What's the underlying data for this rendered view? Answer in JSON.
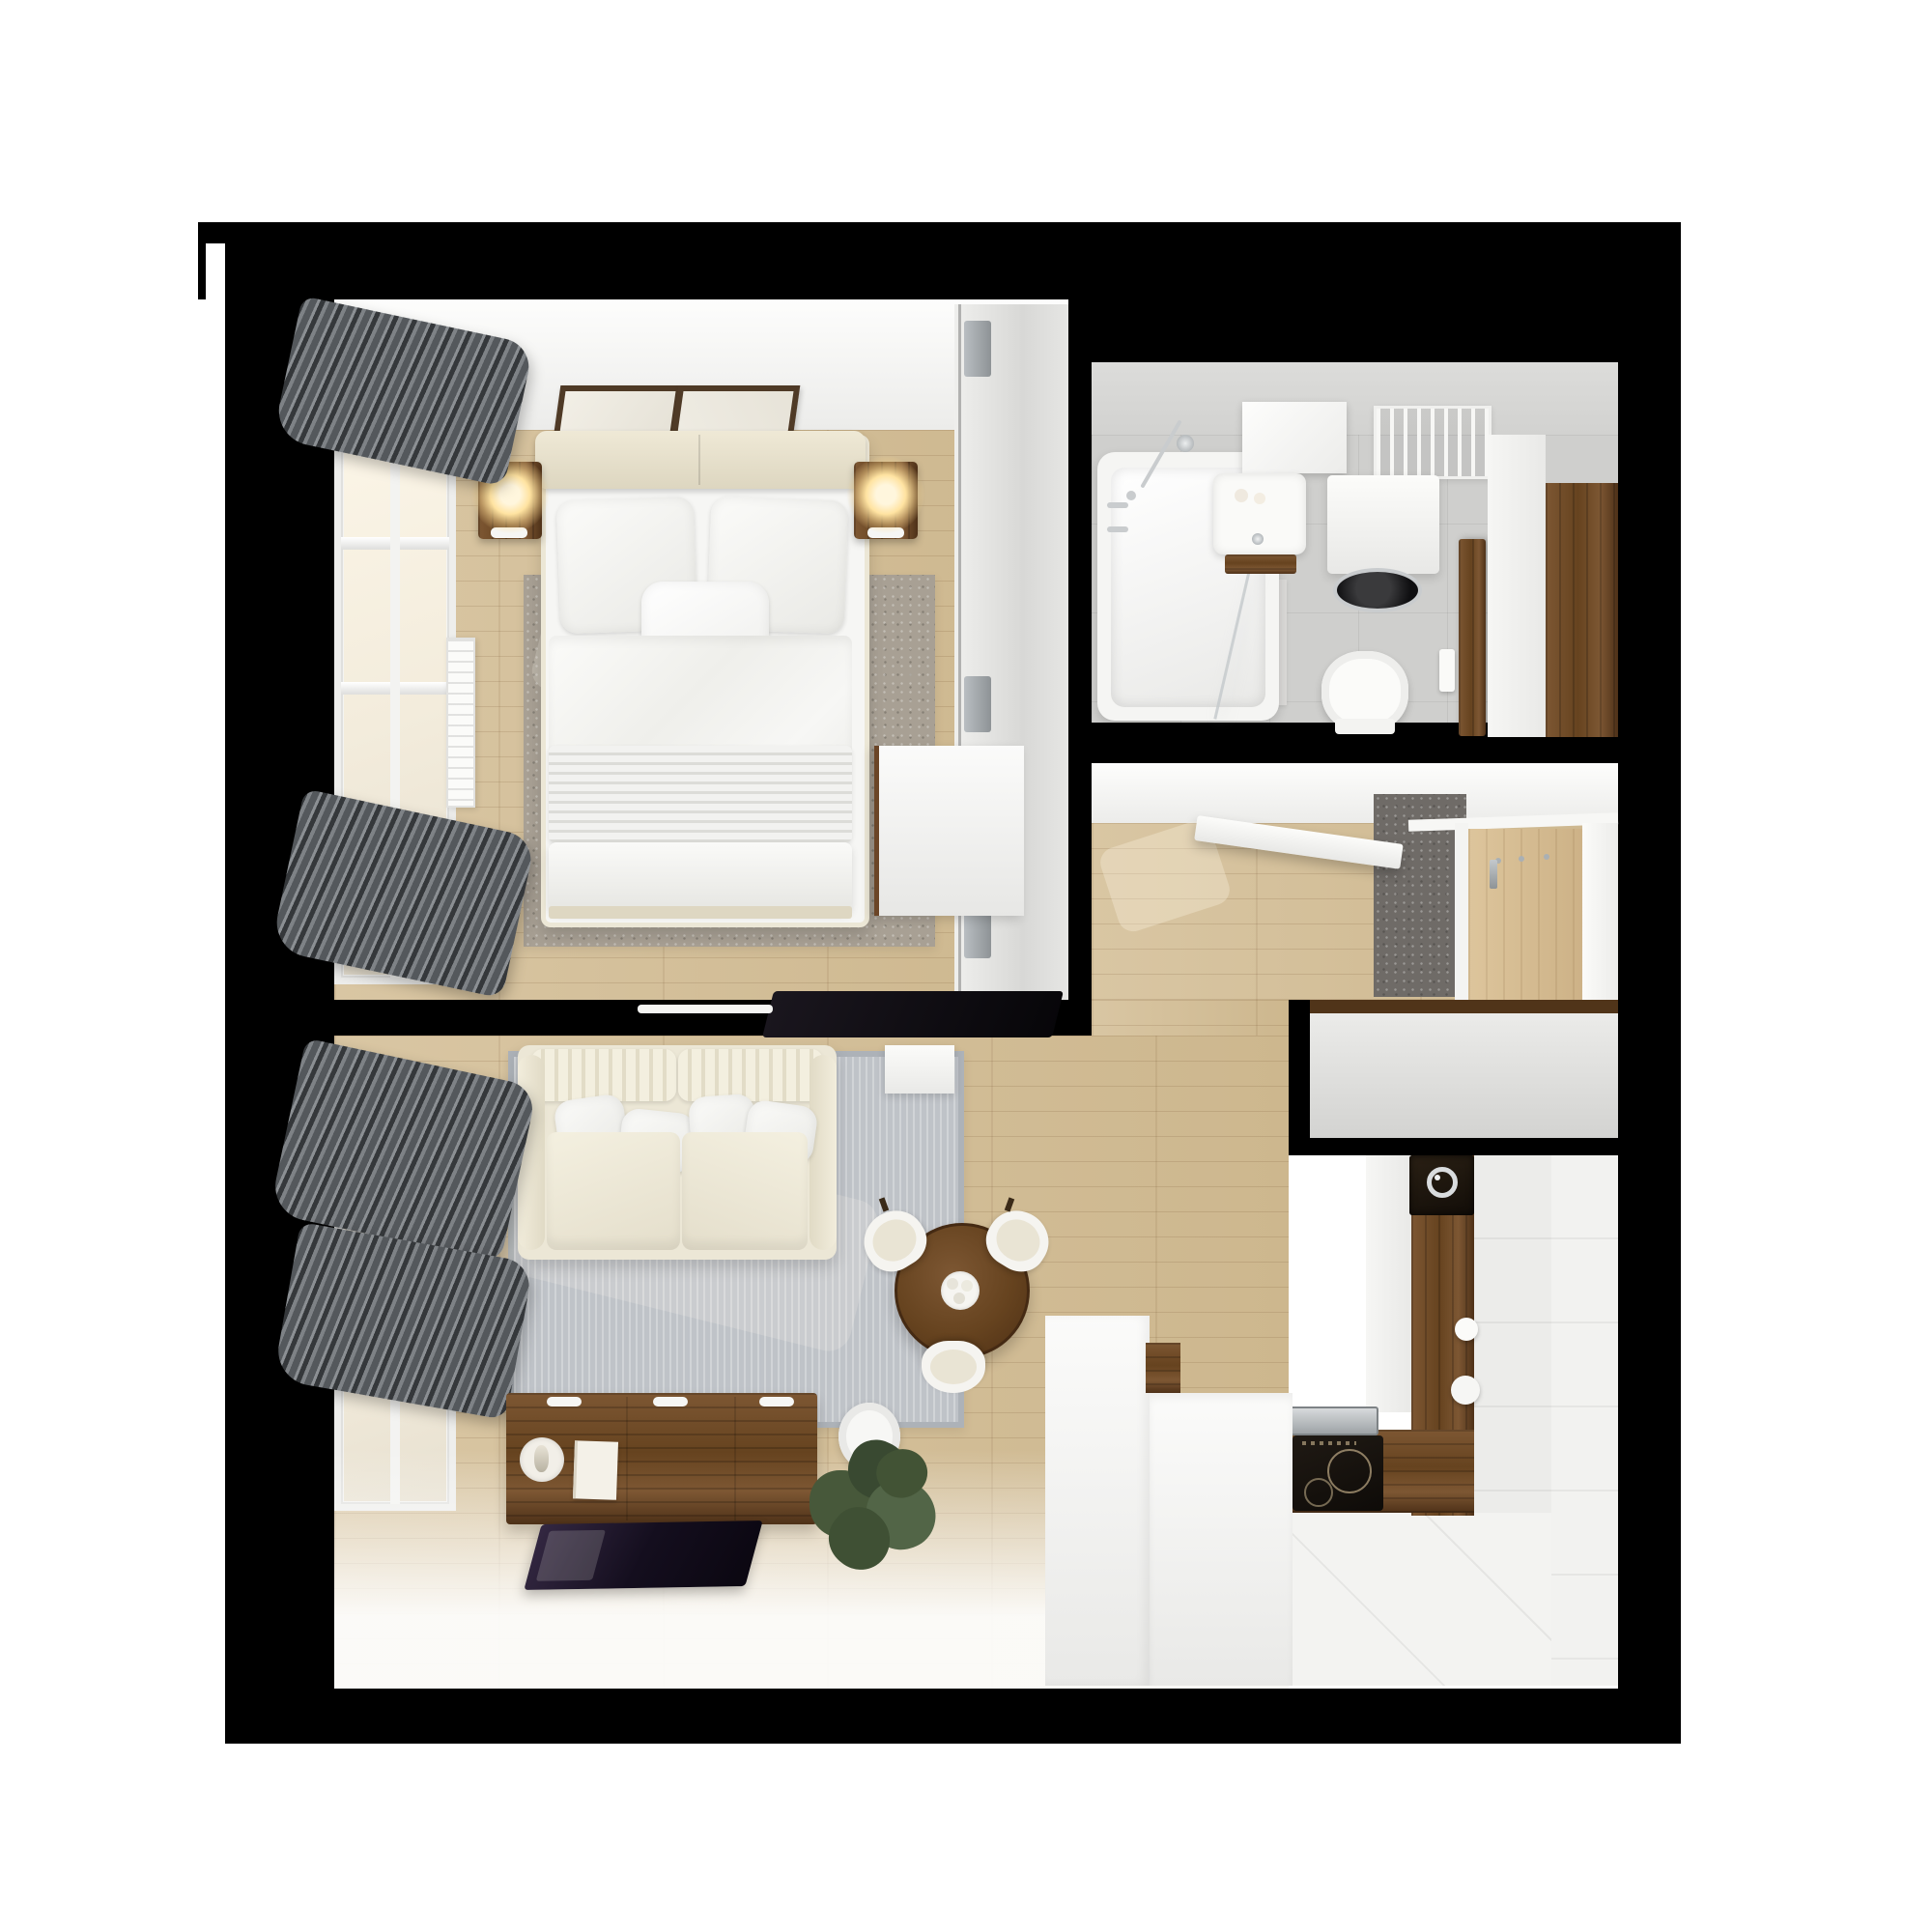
{
  "scene": {
    "type": "3d-floor-plan-render",
    "view": "top-down",
    "description": "Photorealistic top-down 3D render of a one-bedroom apartment: bedroom with double bed, bathroom, entry hallway, open living room with dining area and L-shaped kitchen",
    "background": "white",
    "visible_text": ""
  },
  "palette": {
    "wall": "#000000",
    "bg": "#ffffff",
    "wood_light": "#d9c6a3",
    "wood_mid": "#cdb78e",
    "walnut_light": "#7d5733",
    "walnut_mid": "#66431f",
    "walnut_dark": "#4e3118",
    "cream": "#ece7d6",
    "bedding": "#f6f6f4",
    "rug_bedroom": "#a8a094",
    "rug_living": "#bfc3c8",
    "tile_wall": "#dcdcda",
    "tile_floor": "#cfcfcd",
    "kitchen_white": "#f3f3f1",
    "curtain_dark": "#35383b",
    "curtain_mid": "#54585c",
    "curtain_light": "#7e8286",
    "lamp_glow": "#ffe3a1",
    "screen_dark": "#140e1e",
    "chrome": "#c9ccce",
    "plant_dark": "#394931",
    "plant_mid": "#47583a",
    "plant_light": "#526547"
  },
  "labels": {
    "floorplan": "Top-down 3D apartment floor plan render",
    "bedroom": "Bedroom",
    "bathroom": "Bathroom",
    "hallway": "Hallway",
    "living_room": "Living room",
    "kitchen": "Kitchen",
    "bed": "Double bed with white bedding",
    "headboard": "Upholstered headboard",
    "pillow": "White pillow",
    "duvet": "White duvet",
    "blanket": "Striped blanket",
    "bedroom_rug": "Gray area rug",
    "nightstand": "Walnut nightstand",
    "lamp": "Lit bedside lamp",
    "artwork": "Framed artwork",
    "wardrobe": "Sliding-door wardrobe",
    "dresser": "White cabinet",
    "bedroom_tv": "Wall-mounted TV",
    "window": "Window",
    "curtains": "Gray curtains",
    "radiator": "Radiator",
    "bathtub": "Bathtub with shower fittings",
    "shower_screen": "Glass shower screen",
    "basin": "Washbasin with walnut shelf",
    "mirror": "Mirror panel",
    "towel_radiator": "Towel radiator",
    "washing_machine": "Washing machine",
    "toilet": "Wall-hung toilet",
    "flush_plate": "Flush plate",
    "bath_mat": "Bath mat",
    "bathroom_door": "Open walnut door",
    "entry_cabinet": "Walnut entry panel",
    "runner": "Gray runner rug",
    "coat_rack": "Coat rack panel with hooks",
    "hall_door": "Open white door",
    "storage_unit": "Built-in storage unit",
    "sofa": "Cream fabric sofa",
    "living_rug": "Light gray rug",
    "side_table": "White side table",
    "sideboard": "Walnut sideboard",
    "tv": "Flat-screen TV",
    "plant": "Potted green plant",
    "wall_clock": "White ribbed clock",
    "dining_table": "Round walnut dining table",
    "dining_chair": "White dining chair",
    "tableware": "Tableware set",
    "counter": "Walnut countertop",
    "kitchen_sink": "Kitchen sink with faucet",
    "cooktop": "Induction cooktop",
    "extractor": "Stainless steel inset",
    "kitchen_cabinets": "White kitchen cabinets",
    "peninsula": "White peninsula counter",
    "canister": "White canister",
    "kitchen_floor": "White tiled kitchen floor"
  }
}
